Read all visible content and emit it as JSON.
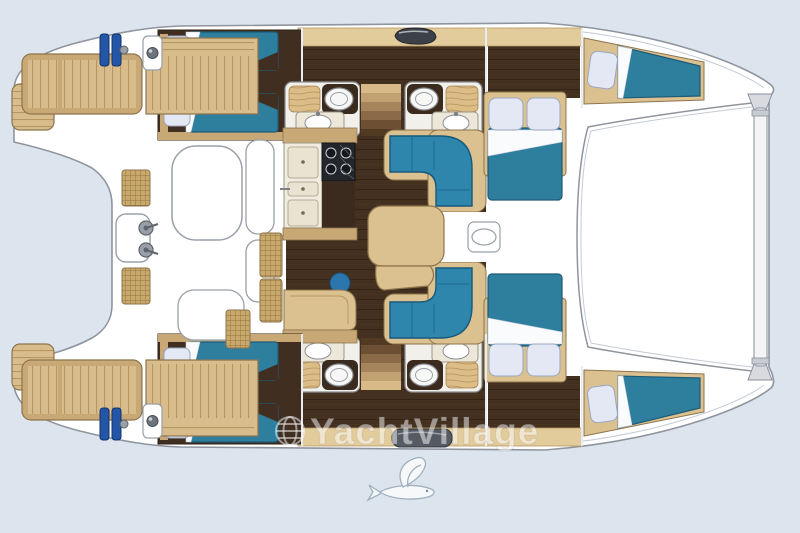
{
  "meta": {
    "type": "yacht-floor-plan",
    "vessel": "catamaran",
    "view": "top-down interior layout"
  },
  "watermark": {
    "text": "YachtVillage",
    "icon": "globe-icon"
  },
  "logo": {
    "name": "flying-fish-logo"
  },
  "palette": {
    "background": "#dce4ee",
    "hull_white": "#ffffff",
    "outline_gray": "#8f959e",
    "teak_deck": "#d9bc8b",
    "teak_stripe": "#b69764",
    "wood_trim": "#c8a975",
    "tan_band": "#e3cc9c",
    "floor_dark": "#43301f",
    "wardrobe_dark": "#3a2b1e",
    "mattress_teal": "#2e7e9e",
    "mattress_edge": "#1d5b77",
    "settee_blue": "#2f86ad",
    "pillow": "#e4e8f4",
    "sheet_white": "#fafbfd",
    "counter_cream": "#f0ece0",
    "stove_dark": "#23262b",
    "winch_blue": "#2456a8",
    "fixture_white": "#f7f7f5",
    "rattan": "#c9a96b"
  },
  "plan": {
    "port_hull": {
      "cabins": [
        {
          "name": "aft cabin",
          "berths": 2
        },
        {
          "name": "forward cabin",
          "berths": 1,
          "bed": "double"
        },
        {
          "name": "bow berth",
          "berths": 1
        }
      ],
      "bathrooms": 2
    },
    "starboard_hull": {
      "cabins": [
        {
          "name": "aft cabin",
          "berths": 2
        },
        {
          "name": "forward cabin",
          "berths": 1,
          "bed": "double"
        },
        {
          "name": "bow berth",
          "berths": 1
        }
      ],
      "bathrooms": 2
    },
    "saloon": {
      "features": [
        "galley counter with sinks",
        "stove",
        "chart table",
        "nav seat",
        "facing settees",
        "saloon table",
        "two companionway stairs",
        "deck hatch"
      ]
    },
    "cockpit": {
      "features": [
        "cockpit table",
        "bench seats",
        "helm pod with winches",
        "rattan seats",
        "teak decks",
        "swim platforms",
        "mooring winches"
      ]
    },
    "foredeck": {
      "features": [
        "trampoline area",
        "forward crossbeam"
      ]
    }
  }
}
